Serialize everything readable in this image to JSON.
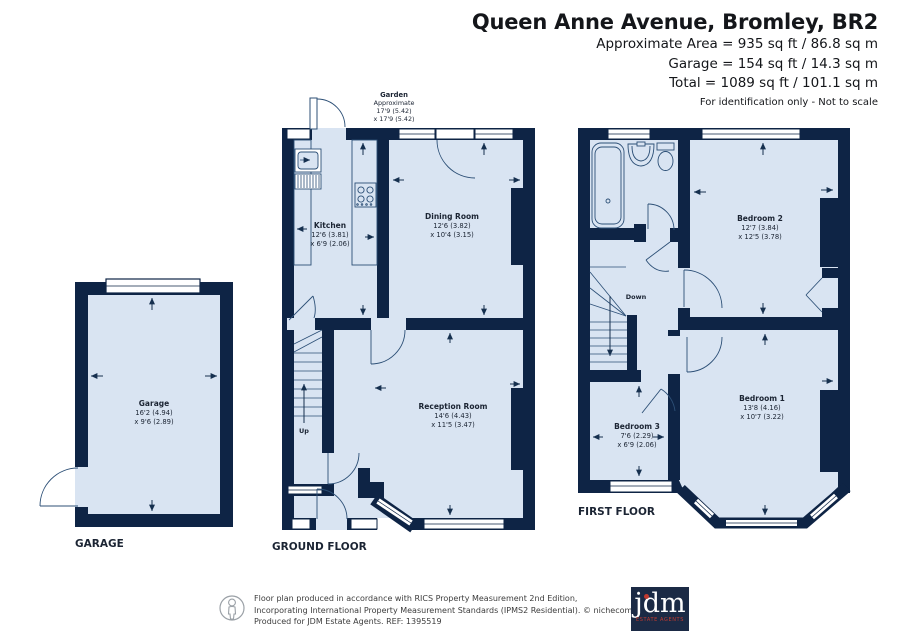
{
  "header": {
    "title": "Queen Anne Avenue, Bromley, BR2",
    "lines": [
      "Approximate Area = 935 sq ft / 86.8 sq m",
      "Garage = 154 sq ft / 14.3 sq m",
      "Total = 1089 sq ft / 101.1 sq m"
    ],
    "note": "For identification only - Not to scale"
  },
  "floors": {
    "garage": {
      "label": "GARAGE",
      "room": {
        "name": "Garage",
        "d1": "16'2 (4.94)",
        "d2": "x 9'6 (2.89)"
      }
    },
    "ground": {
      "label": "GROUND FLOOR",
      "garden": {
        "name": "Garden",
        "l1": "Approximate",
        "l2": "17'9 (5.42)",
        "l3": "x 17'9 (5.42)"
      },
      "kitchen": {
        "name": "Kitchen",
        "d1": "12'6 (3.81)",
        "d2": "x 6'9 (2.06)"
      },
      "dining": {
        "name": "Dining Room",
        "d1": "12'6 (3.82)",
        "d2": "x 10'4 (3.15)"
      },
      "reception": {
        "name": "Reception Room",
        "d1": "14'6 (4.43)",
        "d2": "x 11'5 (3.47)"
      },
      "stairs": "Up"
    },
    "first": {
      "label": "FIRST FLOOR",
      "bedroom1": {
        "name": "Bedroom 1",
        "d1": "13'8 (4.16)",
        "d2": "x 10'7 (3.22)"
      },
      "bedroom2": {
        "name": "Bedroom 2",
        "d1": "12'7 (3.84)",
        "d2": "x 12'5 (3.78)"
      },
      "bedroom3": {
        "name": "Bedroom 3",
        "d1": "7'6 (2.29)",
        "d2": "x 6'9 (2.06)"
      },
      "stairs": "Down"
    }
  },
  "footer": {
    "line1": "Floor plan produced in accordance with RICS Property Measurement 2nd Edition,",
    "line2": "Incorporating International Property Measurement Standards (IPMS2 Residential).   © nichecom 2026.",
    "line3": "Produced for JDM Estate Agents.   REF: 1395519",
    "logo_text": "jdm",
    "logo_sub": "ESTATE AGENTS"
  },
  "colors": {
    "wall": "#0e2445",
    "floor": "#d9e4f2",
    "line": "#2c4f76",
    "accent_red": "#c13a30"
  }
}
